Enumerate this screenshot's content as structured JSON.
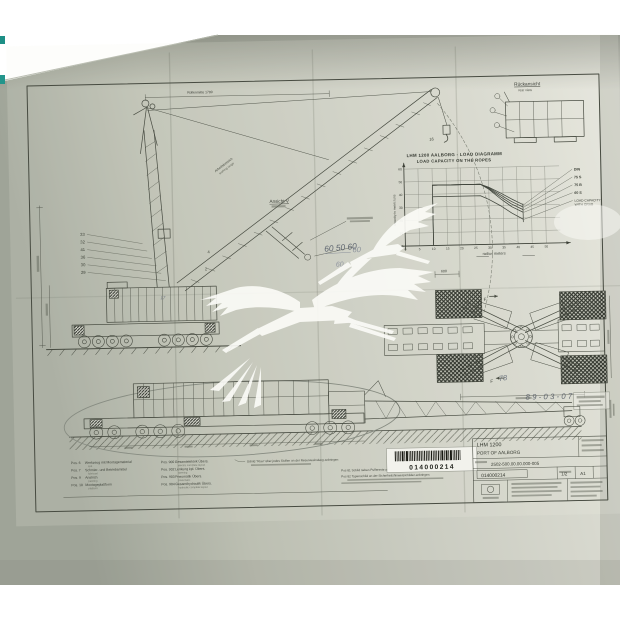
{
  "chart_data": {
    "type": "line",
    "title": "LHM 1200 AALBORG - LOAD DIAGRAMM",
    "subtitle": "LOAD CAPACITY ON THE ROPES",
    "xlabel": "radius meters",
    "ylabel": "capacity in metric tons",
    "xlim": [
      0,
      55
    ],
    "ylim": [
      0,
      60
    ],
    "xticks": [
      0,
      5,
      10,
      15,
      20,
      25,
      30,
      35,
      40,
      45,
      50
    ],
    "yticks": [
      0,
      10,
      20,
      30,
      40,
      50,
      60
    ],
    "grid": true,
    "legend_position": "right",
    "end_line_radius": 42,
    "series": [
      {
        "name": "DIN",
        "points": [
          [
            10,
            0
          ],
          [
            10,
            47
          ],
          [
            27,
            47
          ],
          [
            30,
            44.5
          ],
          [
            34,
            40
          ],
          [
            38,
            35
          ],
          [
            42,
            30.5
          ]
        ]
      },
      {
        "name": "75 S",
        "points": [
          [
            10,
            47
          ],
          [
            27,
            47
          ],
          [
            30,
            44
          ],
          [
            34,
            38.5
          ],
          [
            38,
            33
          ],
          [
            42,
            28.5
          ]
        ]
      },
      {
        "name": "75 B",
        "points": [
          [
            10,
            47
          ],
          [
            27,
            47
          ],
          [
            30,
            43.5
          ],
          [
            34,
            37
          ],
          [
            38,
            31
          ],
          [
            42,
            26.5
          ]
        ]
      },
      {
        "name": "60 S",
        "points": [
          [
            10,
            47
          ],
          [
            27,
            47
          ],
          [
            30,
            43
          ],
          [
            34,
            35.5
          ],
          [
            38,
            29
          ],
          [
            42,
            24.5
          ]
        ]
      },
      {
        "name": "LOAD CAPACITY WITH GRAB",
        "points": [
          [
            10,
            0
          ],
          [
            10,
            38
          ],
          [
            27,
            38
          ],
          [
            30,
            35
          ],
          [
            34,
            30
          ],
          [
            38,
            24
          ],
          [
            42,
            19
          ]
        ]
      }
    ]
  },
  "views": {
    "rear_view_de": "Rückansicht",
    "rear_view_en": "rear view",
    "detail_label": "Ansicht V",
    "working_range_de": "Arbeitsbereich",
    "working_range_en": "working range",
    "top_dim": "Rollenmitte 1700",
    "plan_dim": "600",
    "plan_f_label": "F"
  },
  "handwritten": {
    "boom_dims": "60 50 60",
    "stray_dim": "60",
    "pad_mark": "78",
    "date": "89-03-07"
  },
  "balloons": {
    "left": [
      "33",
      "32",
      "41",
      "36",
      "30",
      "29"
    ],
    "misc": [
      "2",
      "4",
      "16",
      "17"
    ]
  },
  "pos_list_left": [
    {
      "pos": "Pos. 6",
      "de": "Werkzeug mit Montagematerial",
      "en": "tool"
    },
    {
      "pos": "Pos. 7",
      "de": "Schmier- und Betriebsmittel",
      "en": "lubricant"
    },
    {
      "pos": "Pos. 9",
      "de": "Anstrich",
      "en": "painting"
    },
    {
      "pos": "Pos. 10",
      "de": "Montageplattform",
      "en": "platform"
    }
  ],
  "pos_list_middle": [
    {
      "pos": "Pos. 900",
      "de": "Gesamtelektrik Übers.",
      "en": "electric complete layout"
    },
    {
      "pos": "Pos. 902",
      "de": "Lenkung kpl. Übers.",
      "en": "steering"
    },
    {
      "pos": "Pos. 903",
      "de": "Pneumatik Übers.",
      "en": "pneumatic"
    },
    {
      "pos": "Pos. 904",
      "de": "Gesamthydraulik Übers.",
      "en": "hydraulic complete layout"
    }
  ],
  "notes": {
    "plate_note": "Schild \"Klau\" über jedes Stollen an der Reservewindung anbringen",
    "pos81": "Pos 81  Schild neben Puffereste anbringen",
    "pos82": "Pos 82  Typenschild an der Sicherheitshinweisschilder anbringen"
  },
  "barcode": {
    "value": "014000214"
  },
  "title_block": {
    "model": "LHM 1200",
    "project": "PORT OF AALBORG",
    "drawing_no": "2502-500.00.00.000-005",
    "doc_no": "014000214",
    "sheet": "1/2",
    "format": "A1"
  },
  "watermark": {
    "icon": "stork-silhouette",
    "count": 2
  }
}
